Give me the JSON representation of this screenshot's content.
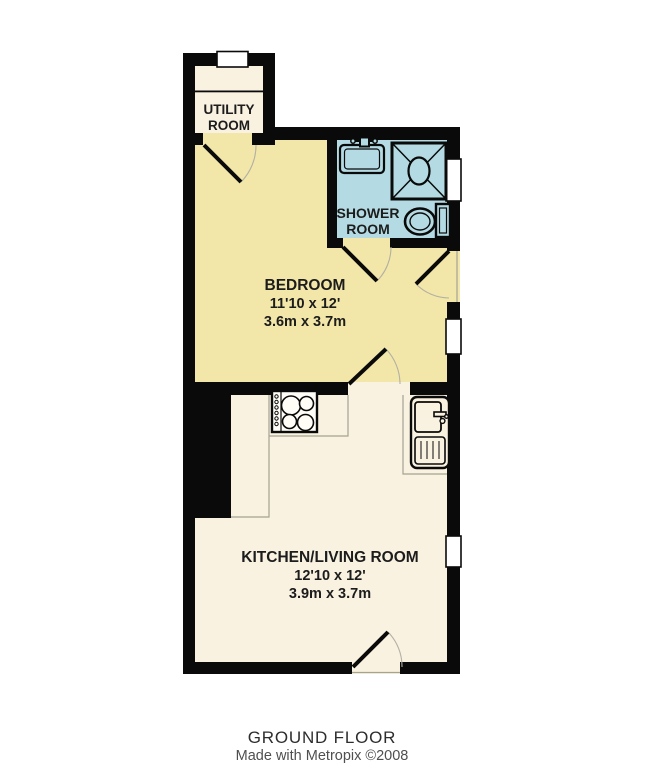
{
  "plan": {
    "floor_label": "GROUND FLOOR",
    "credit": "Made with Metropix ©2008"
  },
  "rooms": {
    "utility": {
      "line1": "UTILITY",
      "line2": "ROOM"
    },
    "shower": {
      "line1": "SHOWER",
      "line2": "ROOM"
    },
    "bedroom": {
      "name": "BEDROOM",
      "imperial": "11'10 x 12'",
      "metric": "3.6m x 3.7m"
    },
    "kitchen": {
      "name": "KITCHEN/LIVING ROOM",
      "imperial": "12'10 x 12'",
      "metric": "3.9m x 3.7m"
    }
  },
  "fixtures": {
    "shower_room": [
      "washbasin",
      "shower-cubicle",
      "toilet"
    ],
    "kitchen": [
      "hob",
      "sink-with-drainer"
    ],
    "counts": {
      "windows": 4,
      "doors": 5
    }
  },
  "colors": {
    "wall": "#0a0a0a",
    "bedroom": "#f2e7a9",
    "kitchen": "#f9f2e1",
    "utility": "#f9f2e1",
    "shower": "#b4dbe3",
    "window": "#ffffff",
    "stove": "#fffdf6",
    "counter": "#a5a394",
    "arc": "#b3b0a4",
    "label_text": "#1c1c1c",
    "floor_label_text": "#2d2d2d",
    "credit_text": "#4f4f4f"
  }
}
